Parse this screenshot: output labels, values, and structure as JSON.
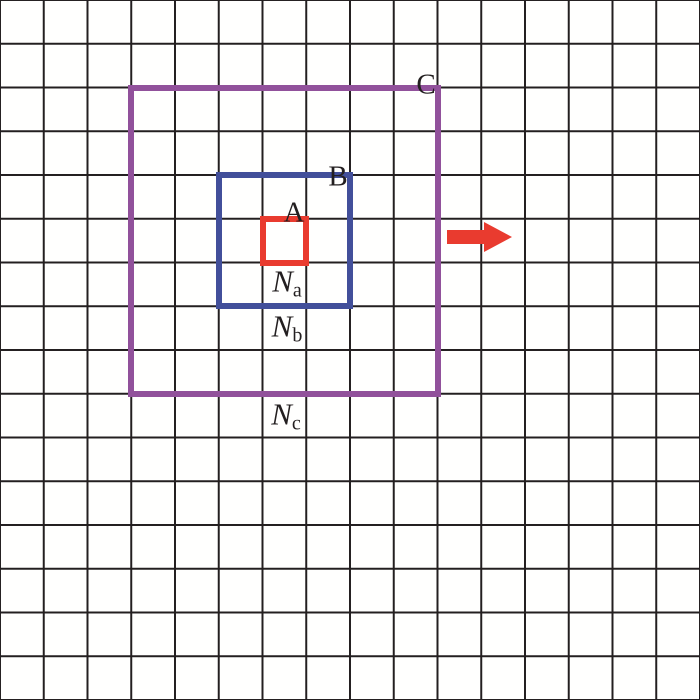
{
  "figure": {
    "background_color": "#fffffe",
    "grid": {
      "columns": 16,
      "rows": 16,
      "line_color": "#231f20"
    },
    "squares": [
      {
        "label": "A",
        "color": "#e93b2f",
        "size_cells": 1,
        "neighbor_label": {
          "base": "N",
          "subscript": "a"
        }
      },
      {
        "label": "B",
        "color": "#424f9a",
        "size_cells": 3,
        "neighbor_label": {
          "base": "N",
          "subscript": "b"
        }
      },
      {
        "label": "C",
        "color": "#91519b",
        "size_cells": 7,
        "neighbor_label": {
          "base": "N",
          "subscript": "c"
        }
      }
    ],
    "arrow": {
      "color": "#e93b2f",
      "direction": "right"
    }
  }
}
